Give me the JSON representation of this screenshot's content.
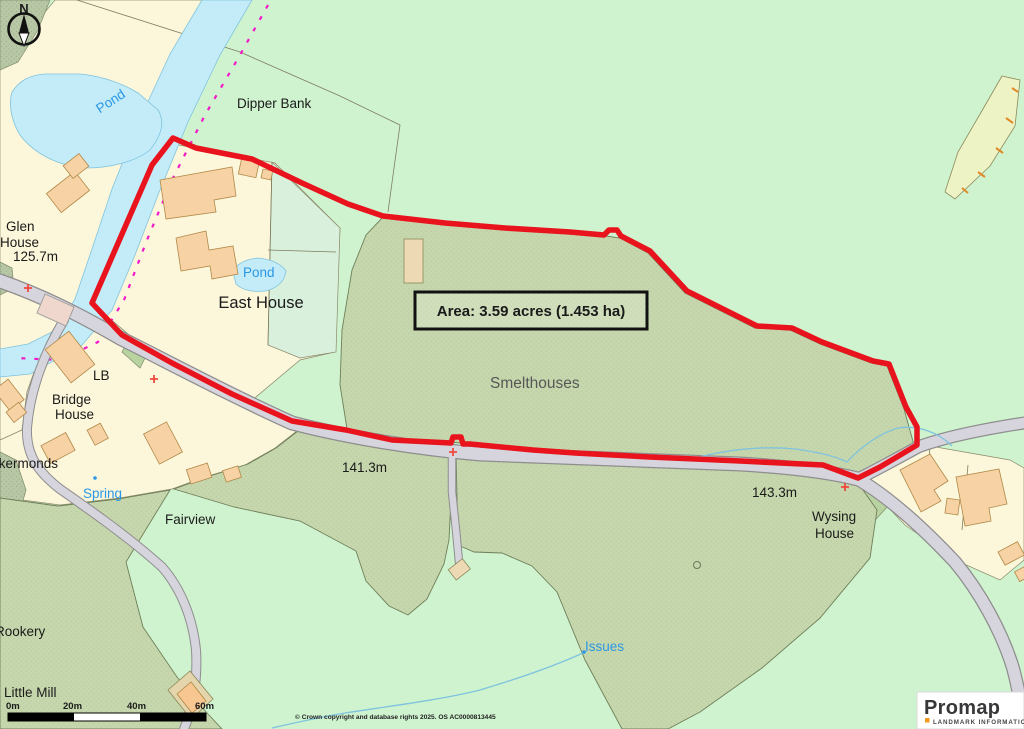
{
  "map": {
    "labels": {
      "pond_upper": "Pond",
      "dipper_bank": "Dipper Bank",
      "glen_house_1": "Glen",
      "glen_house_2": "House",
      "spot_height_1": "125.7m",
      "pond_lower": "Pond",
      "east_house": "East House",
      "lb": "LB",
      "bridge_house_1": "Bridge",
      "bridge_house_2": "House",
      "cockermonds": "ckermonds",
      "spring": "Spring",
      "fairview": "Fairview",
      "smelthouses": "Smelthouses",
      "spot_height_2": "141.3m",
      "spot_height_3": "143.3m",
      "wysing_house_1": "Wysing",
      "wysing_house_2": "House",
      "issues": "Issues",
      "rookery": "Rookery",
      "little_mill": "Little Mill"
    },
    "area_box": {
      "label": "Area: 3.59 acres (1.453 ha)"
    },
    "compass": {
      "label": "N"
    },
    "scale_bar": {
      "ticks": [
        "0m",
        "20m",
        "40m",
        "60m"
      ]
    },
    "copyright": "© Crown copyright and database rights 2025. OS AC0000813445",
    "logo": {
      "brand": "Promap",
      "tagline": "LANDMARK INFORMATION"
    },
    "colors": {
      "boundary_red": "#e8131c",
      "water_blue": "#c3ecf8",
      "water_edge": "#7fc3de",
      "admin_boundary_magenta": "#f318c9",
      "field_olive": "#c6d7ad",
      "parcel_cream": "#fcf6da",
      "background_green": "#cff3cf",
      "building_orange": "#f7d2a4",
      "road_gray": "#d6d5dd"
    }
  }
}
